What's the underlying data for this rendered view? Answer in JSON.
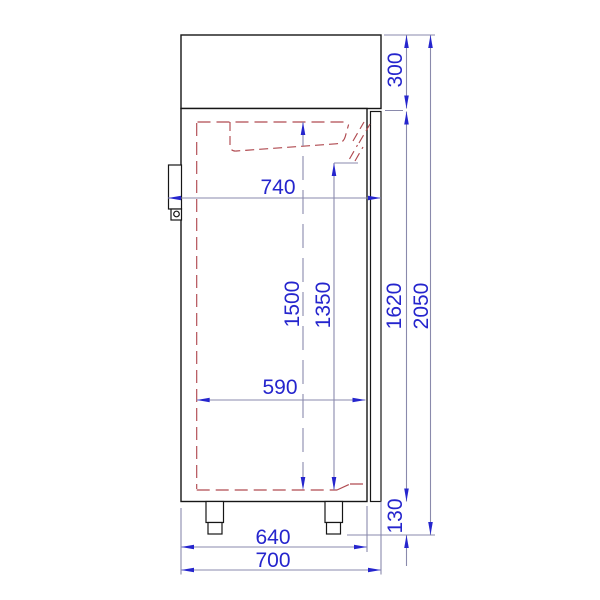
{
  "drawing": {
    "kind": "technical-dimension-drawing",
    "subject": "upright-cabinet-side-view",
    "background": "#ffffff",
    "line_colors": {
      "outline": "#161616",
      "dimension_line": "#8a8aac",
      "dimension_accent": "#2525cd",
      "hidden_feature": "#b04a50"
    },
    "dimensions": {
      "top_section_height": "300",
      "overall_height": "2050",
      "door_height": "1620",
      "feet_height": "130",
      "depth_with_hinge": "740",
      "interior_height": "1500",
      "interior_height_front": "1350",
      "interior_depth": "590",
      "body_depth": "640",
      "depth_with_door": "700"
    }
  }
}
